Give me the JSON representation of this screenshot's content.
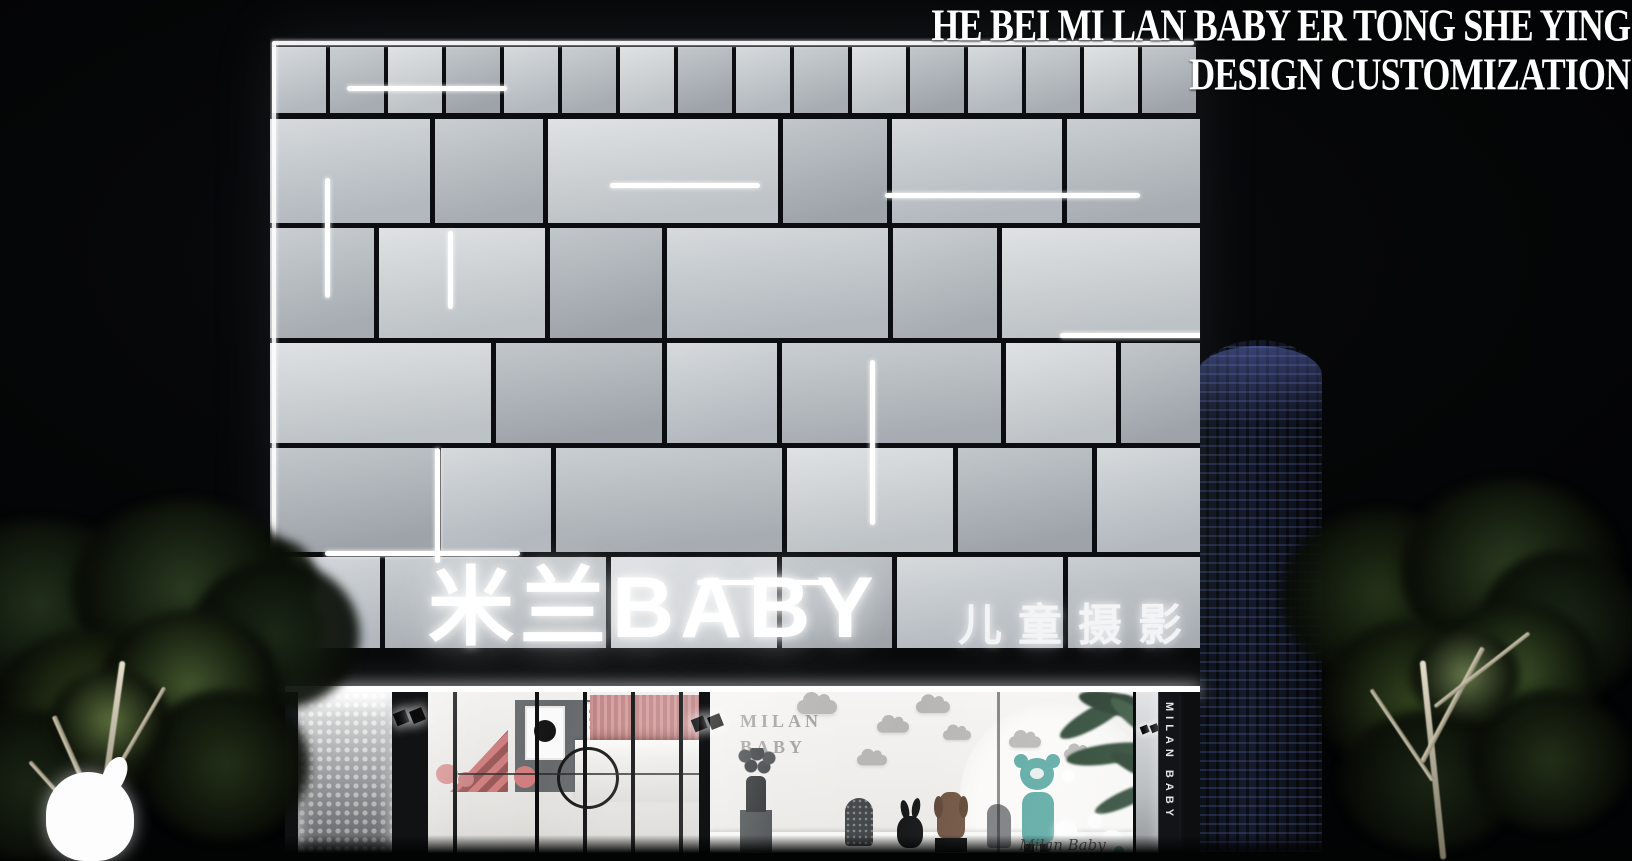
{
  "caption": {
    "line1": "HE BEI MI LAN BABY ER TONG SHE YING",
    "line2": "DESIGN CUSTOMIZATION"
  },
  "signage": {
    "main": "米兰BABY",
    "sub": "儿童摄影"
  },
  "window_display": {
    "wall_text_line1": "MILAN",
    "wall_text_line2": "BABY",
    "script_text": "Milan Baby"
  },
  "blade_sign": {
    "text": "MILAN BABY"
  },
  "colors": {
    "sky": "#050607",
    "panel_light": "#d6dadd",
    "panel_dark": "#a0a6ab",
    "joint": "#0b0d10",
    "led_white": "#ffffff",
    "interior_pink": "#d49c9c",
    "bear_teal": "#58a7a1",
    "tower_light_blue": "#7a8ce6",
    "foliage_green": "#2c3c20"
  }
}
